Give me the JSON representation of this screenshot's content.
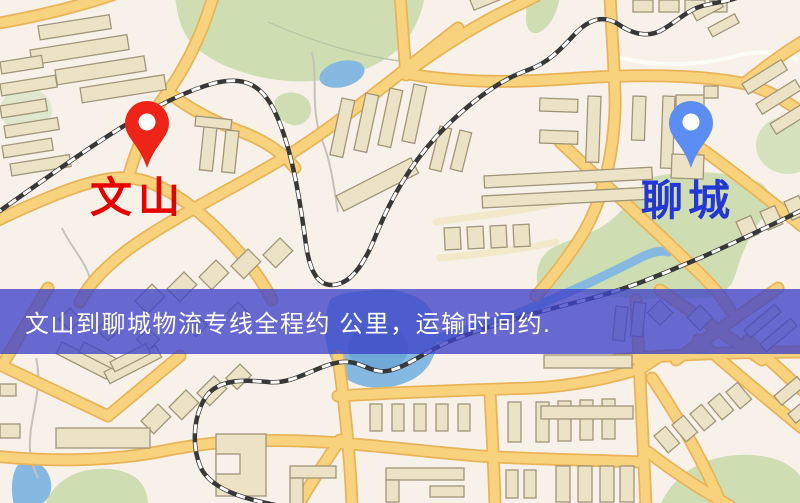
{
  "banner": {
    "text": "文山到聊城物流专线全程约 公里，运输时间约.",
    "background": "rgba(62,66,200,0.78)",
    "text_color": "#ffffff"
  },
  "origin_marker": {
    "label": "文山",
    "label_color": "#e60000",
    "pin_color": "#ee2418",
    "pin_dot_color": "#ffffff",
    "icon": "map-pin"
  },
  "destination_marker": {
    "label": "聊城",
    "label_color": "#2436d4",
    "pin_color": "#5b8df2",
    "pin_dot_color": "#ffffff",
    "icon": "map-pin"
  },
  "map_palette": {
    "background": "#f8f1ea",
    "road_fill": "#f9d27e",
    "road_casing": "#e9b457",
    "minor_street": "#f3e8c9",
    "building_fill": "#ece3c6",
    "building_outline": "#a1957a",
    "park_green": "#cfdeb2",
    "park_green_light": "#dfe8cd",
    "water_blue": "#85b9e2",
    "water_deep": "#6fa9d8",
    "railway_dark": "#383838",
    "railway_dash": "#ffffff"
  }
}
